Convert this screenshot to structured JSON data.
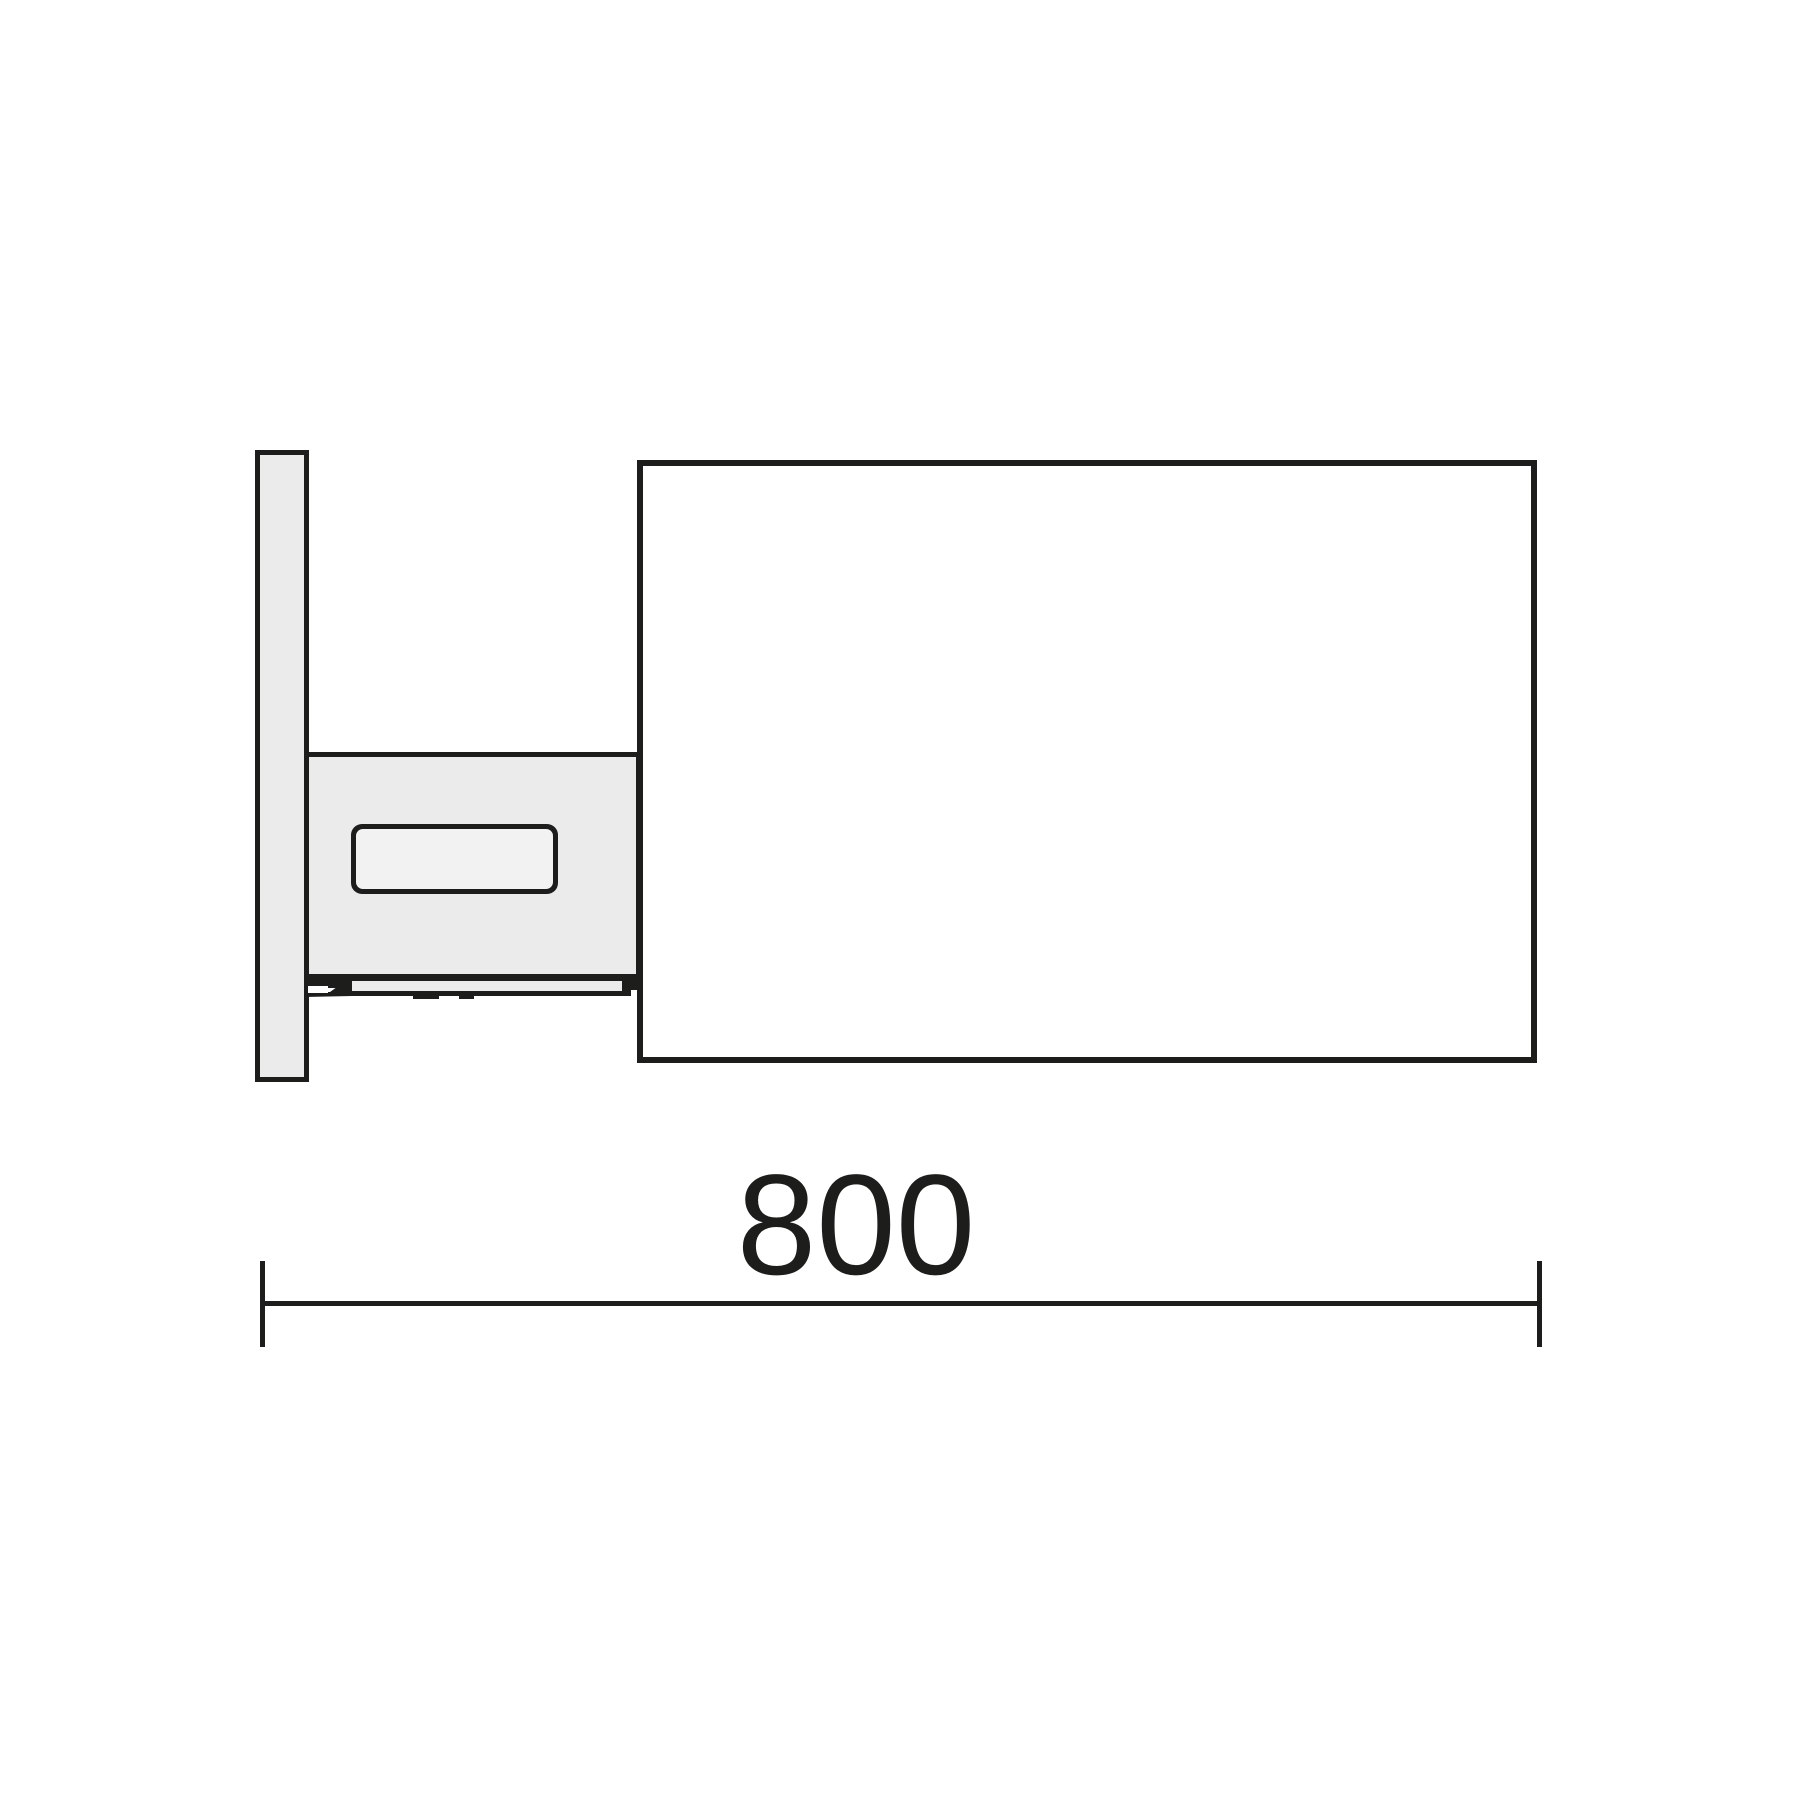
{
  "drawing": {
    "dimension": {
      "label": "800"
    },
    "colors": {
      "line": "#1d1d1b",
      "panel": "#ebebeb",
      "recess": "#f2f2f2",
      "cabinet": "#ffffff",
      "background": "#ffffff"
    }
  }
}
